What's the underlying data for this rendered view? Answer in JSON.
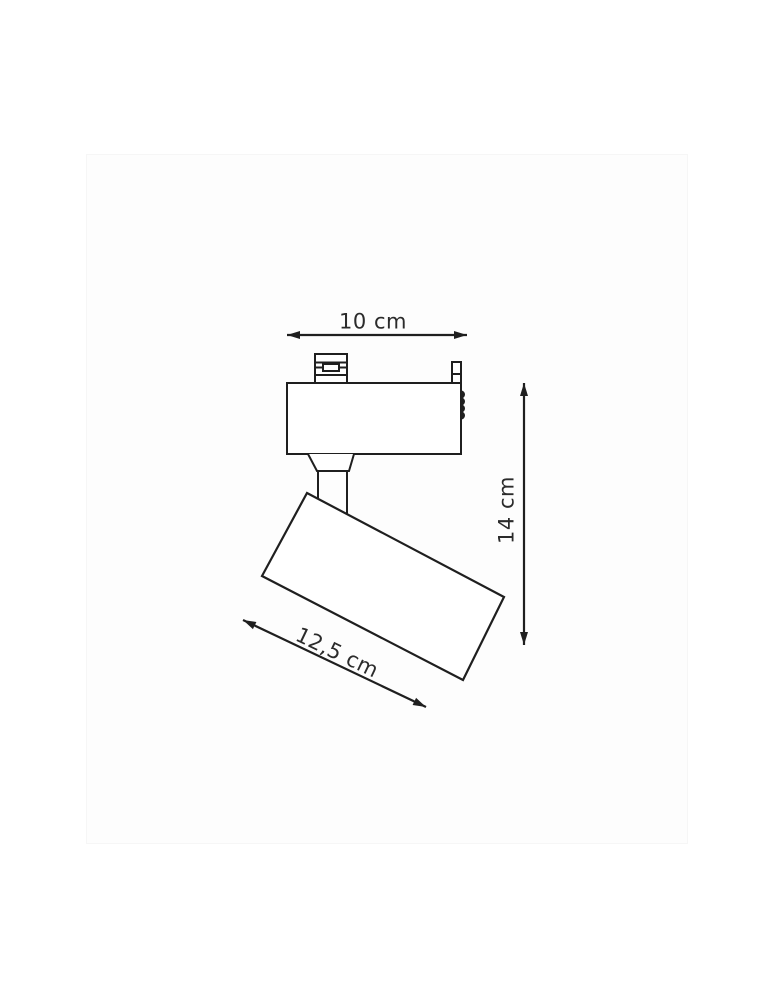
{
  "image_frame": {
    "background": "#fdfdfd"
  },
  "drawing": {
    "line_color": "#1f1f1f",
    "label_color": "#2b2b2b",
    "dimension_labels": {
      "adapter_width": "10 cm",
      "overall_height": "14 cm",
      "head_length": "12,5 cm"
    }
  }
}
